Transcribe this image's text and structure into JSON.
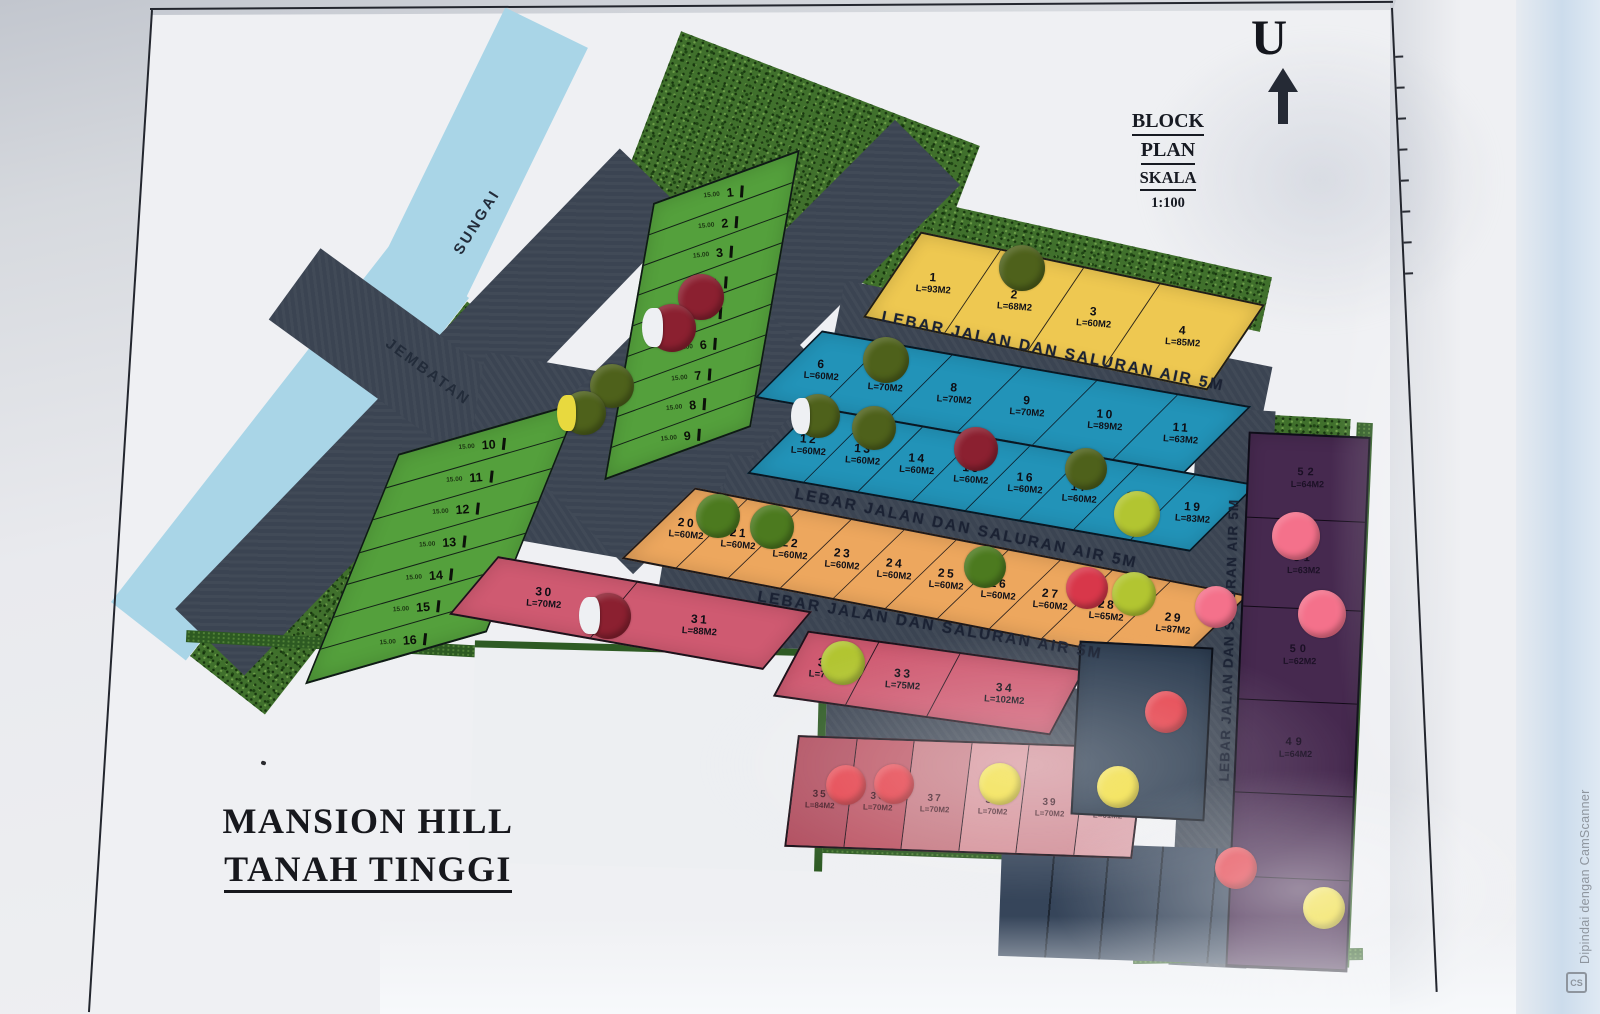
{
  "palette": {
    "green": "#54a03c",
    "teal": "#2293b8",
    "yellow": "#eec851",
    "orange": "#eda75e",
    "pink": "#cf5a71",
    "purple": "#46294f",
    "darkblue": "#2d3d51",
    "pinkRow": [
      "#b25061",
      "#bd5766",
      "#c77b85",
      "#d6939b",
      "#d29099",
      "#daa0a8"
    ],
    "dots": {
      "darkred": "#8b2030",
      "olive": "#4e611b",
      "grn": "#4c7a1f",
      "yellowgreen": "#b2c531",
      "red": "#e5414b",
      "red2": "#d8374a",
      "pinkdot": "#f4718b",
      "yellow": "#f1de3f"
    }
  },
  "header": {
    "north": "U",
    "block_plan": [
      "BLOCK",
      "PLAN",
      "SKALA",
      "1:100"
    ]
  },
  "title": {
    "line1": "MANSION HILL",
    "line2": "TANAH TINGGI"
  },
  "labels": {
    "road": "LEBAR JALAN DAN SALURAN AIR 5M",
    "river": "SUNGAI",
    "bridge": "JEMBATAN"
  },
  "watermark": {
    "text": "Dipindai dengan CamScanner",
    "logo": "CS"
  },
  "sections": [
    {
      "id": "green_a",
      "lots": [
        {
          "no": "1",
          "dim": "15.00"
        },
        {
          "no": "2",
          "dim": "15.00"
        },
        {
          "no": "3",
          "dim": "15.00"
        },
        {
          "no": "4",
          "dim": "15.00"
        },
        {
          "no": "5",
          "dim": "15.00"
        },
        {
          "no": "6",
          "dim": "15.00"
        },
        {
          "no": "7",
          "dim": "15.00"
        },
        {
          "no": "8",
          "dim": "15.00"
        },
        {
          "no": "9",
          "dim": "15.00"
        }
      ]
    },
    {
      "id": "green_b",
      "lots": [
        {
          "no": "10",
          "dim": "15.00"
        },
        {
          "no": "11",
          "dim": "15.00"
        },
        {
          "no": "12",
          "dim": "15.00"
        },
        {
          "no": "13",
          "dim": "15.00"
        },
        {
          "no": "14",
          "dim": "15.00"
        },
        {
          "no": "15",
          "dim": "15.00"
        },
        {
          "no": "16",
          "dim": "15.00"
        }
      ]
    },
    {
      "id": "yellow",
      "lots": [
        {
          "no": "1",
          "area": "L=93M2"
        },
        {
          "no": "2",
          "area": "L=68M2"
        },
        {
          "no": "3",
          "area": "L=60M2"
        },
        {
          "no": "4",
          "area": "L=85M2"
        }
      ]
    },
    {
      "id": "teal_r1",
      "lots": [
        {
          "no": "6",
          "area": "L=60M2"
        },
        {
          "no": "7",
          "area": "L=70M2"
        },
        {
          "no": "8",
          "area": "L=70M2"
        },
        {
          "no": "9",
          "area": "L=70M2"
        },
        {
          "no": "10",
          "area": "L=89M2"
        },
        {
          "no": "11",
          "area": "L=63M2"
        }
      ]
    },
    {
      "id": "teal_r2",
      "lots": [
        {
          "no": "12",
          "area": "L=60M2"
        },
        {
          "no": "13",
          "area": "L=60M2"
        },
        {
          "no": "14",
          "area": "L=60M2"
        },
        {
          "no": "15",
          "area": "L=60M2"
        },
        {
          "no": "16",
          "area": "L=60M2"
        },
        {
          "no": "17",
          "area": "L=60M2"
        },
        {
          "no": "18",
          "area": "L=77M2"
        },
        {
          "no": "19",
          "area": "L=83M2"
        }
      ]
    },
    {
      "id": "orange",
      "lots": [
        {
          "no": "20",
          "area": "L=60M2"
        },
        {
          "no": "21",
          "area": "L=60M2"
        },
        {
          "no": "22",
          "area": "L=60M2"
        },
        {
          "no": "23",
          "area": "L=60M2"
        },
        {
          "no": "24",
          "area": "L=60M2"
        },
        {
          "no": "25",
          "area": "L=60M2"
        },
        {
          "no": "26",
          "area": "L=60M2"
        },
        {
          "no": "27",
          "area": "L=60M2"
        },
        {
          "no": "28",
          "area": "L=65M2"
        },
        {
          "no": "29",
          "area": "L=87M2"
        }
      ]
    },
    {
      "id": "pink_a",
      "lots": [
        {
          "no": "30",
          "area": "L=70M2"
        },
        {
          "no": "31",
          "area": "L=88M2"
        }
      ]
    },
    {
      "id": "pink_b",
      "lots": [
        {
          "no": "32",
          "area": "L=77M2"
        },
        {
          "no": "33",
          "area": "L=75M2"
        },
        {
          "no": "34",
          "area": "L=102M2"
        }
      ]
    },
    {
      "id": "pink_c",
      "lots": [
        {
          "no": "35",
          "area": "L=84M2"
        },
        {
          "no": "36",
          "area": "L=70M2"
        },
        {
          "no": "37",
          "area": "L=70M2"
        },
        {
          "no": "38",
          "area": "L=70M2"
        },
        {
          "no": "39",
          "area": "L=70M2"
        },
        {
          "no": "40",
          "area": "L=61M2"
        }
      ]
    },
    {
      "id": "purple",
      "lots": [
        {
          "no": "52",
          "area": "L=64M2"
        },
        {
          "no": "51",
          "area": "L=63M2"
        },
        {
          "no": "50",
          "area": "L=62M2"
        },
        {
          "no": "49",
          "area": "L=64M2"
        },
        {
          "no": "",
          "area": ""
        },
        {
          "no": "",
          "area": ""
        }
      ]
    },
    {
      "id": "darkblue",
      "lots": [
        {
          "no": "41"
        }
      ]
    }
  ],
  "stickers": [
    {
      "x": 1022,
      "y": 268,
      "d": 46,
      "c": "olive"
    },
    {
      "x": 701,
      "y": 297,
      "d": 46,
      "c": "darkred"
    },
    {
      "x": 672,
      "y": 328,
      "d": 48,
      "c": "darkred",
      "peel": true
    },
    {
      "x": 612,
      "y": 386,
      "d": 44,
      "c": "olive"
    },
    {
      "x": 584,
      "y": 413,
      "d": 44,
      "c": "olive",
      "peel": "#e8d93e"
    },
    {
      "x": 886,
      "y": 360,
      "d": 46,
      "c": "olive"
    },
    {
      "x": 818,
      "y": 416,
      "d": 44,
      "c": "olive",
      "peel": true
    },
    {
      "x": 874,
      "y": 428,
      "d": 44,
      "c": "olive"
    },
    {
      "x": 976,
      "y": 449,
      "d": 44,
      "c": "darkred"
    },
    {
      "x": 1086,
      "y": 469,
      "d": 42,
      "c": "olive"
    },
    {
      "x": 1137,
      "y": 514,
      "d": 46,
      "c": "yellowgreen"
    },
    {
      "x": 718,
      "y": 516,
      "d": 44,
      "c": "grn"
    },
    {
      "x": 772,
      "y": 527,
      "d": 44,
      "c": "grn"
    },
    {
      "x": 985,
      "y": 567,
      "d": 42,
      "c": "grn"
    },
    {
      "x": 1087,
      "y": 588,
      "d": 42,
      "c": "red2"
    },
    {
      "x": 1134,
      "y": 594,
      "d": 44,
      "c": "yellowgreen"
    },
    {
      "x": 1216,
      "y": 607,
      "d": 42,
      "c": "pinkdot"
    },
    {
      "x": 608,
      "y": 616,
      "d": 46,
      "c": "darkred",
      "peel": true
    },
    {
      "x": 843,
      "y": 663,
      "d": 44,
      "c": "yellowgreen"
    },
    {
      "x": 1296,
      "y": 536,
      "d": 48,
      "c": "pinkdot"
    },
    {
      "x": 1322,
      "y": 614,
      "d": 48,
      "c": "pinkdot"
    },
    {
      "x": 1166,
      "y": 712,
      "d": 42,
      "c": "red"
    },
    {
      "x": 846,
      "y": 785,
      "d": 40,
      "c": "red"
    },
    {
      "x": 894,
      "y": 784,
      "d": 40,
      "c": "red"
    },
    {
      "x": 1000,
      "y": 784,
      "d": 42,
      "c": "yellow"
    },
    {
      "x": 1118,
      "y": 787,
      "d": 42,
      "c": "yellow"
    },
    {
      "x": 1236,
      "y": 868,
      "d": 42,
      "c": "red"
    },
    {
      "x": 1324,
      "y": 908,
      "d": 42,
      "c": "yellow"
    }
  ]
}
